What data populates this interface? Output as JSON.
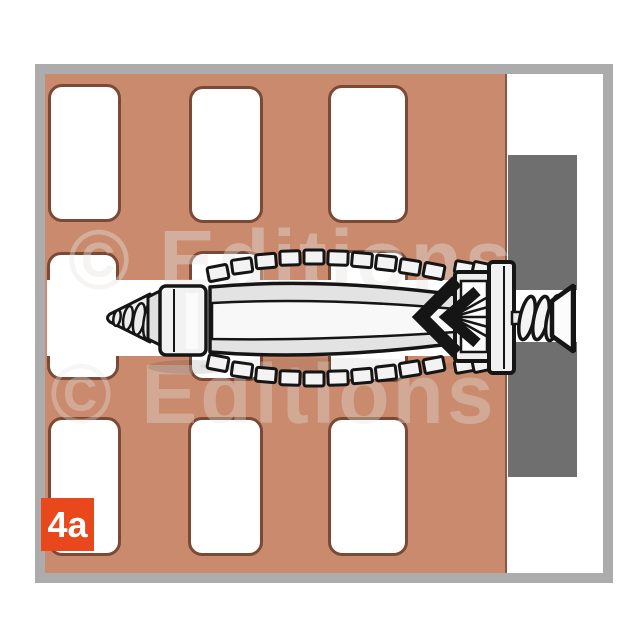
{
  "figure": {
    "step_badge": {
      "label": "4a",
      "background": "#E8481C",
      "text_color": "#FFFFFF"
    },
    "watermark": {
      "line1": "© Editions",
      "line2": "© Editions"
    },
    "illustration": {
      "type": "installation-step-diagram",
      "subject": "universal wall plug with countersunk screw set in hollow brick",
      "elements": [
        "hollow-brick-cross-section",
        "drilled-channel",
        "wall-plug",
        "expansion-arrow-mark",
        "plug-flange",
        "screw-thread",
        "countersunk-screw-head",
        "fixture-panel"
      ]
    },
    "colors": {
      "brick": "#C98A6E",
      "hole_outline": "#7B4A36",
      "brick_edge": "#8A5743",
      "fixture_gray": "#6F6F6F",
      "frame_gray": "#ACACAC",
      "line_art_outline": "#151515",
      "plug_fill": "#F1F1F1",
      "badge_orange": "#E8481C"
    }
  }
}
